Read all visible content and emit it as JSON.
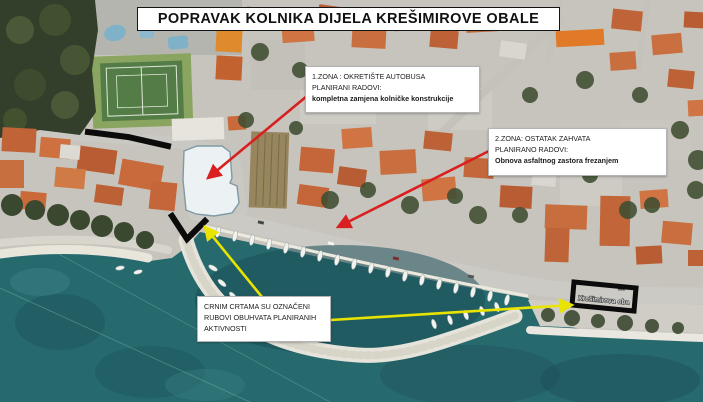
{
  "title": "POPRAVAK KOLNIKA DIJELA KREŠIMIROVE OBALE",
  "boxes": {
    "zone1": {
      "line1": "1.ZONA : OKRETIŠTE AUTOBUSA",
      "line2": "PLANIRANI RADOVI:",
      "line3": "kompletna zamjena kolničke konstrukcije"
    },
    "zone2": {
      "line1": "2.ZONA: OSTATAK ZAHVATA",
      "line2": "PLANIRANO RADOVI:",
      "line3": "Obnova asfaltnog zastora frezanjem"
    },
    "legend": {
      "line1": "CRNIM CRTAMA SU OZNAČENI",
      "line2": "RUBOVI OBUHVATA PLANIRANIH",
      "line3": "AKTIVNOSTI"
    }
  },
  "map": {
    "street_label": "Krešimirova oba"
  },
  "colors": {
    "arrow_red": "#d91f1f",
    "arrow_yellow": "#e8e400",
    "boundary_black": "#0b0b0b",
    "zone_highlight_fill": "#eef4f5",
    "sea": "#266a6e",
    "marina_water": "#1c4f58"
  }
}
